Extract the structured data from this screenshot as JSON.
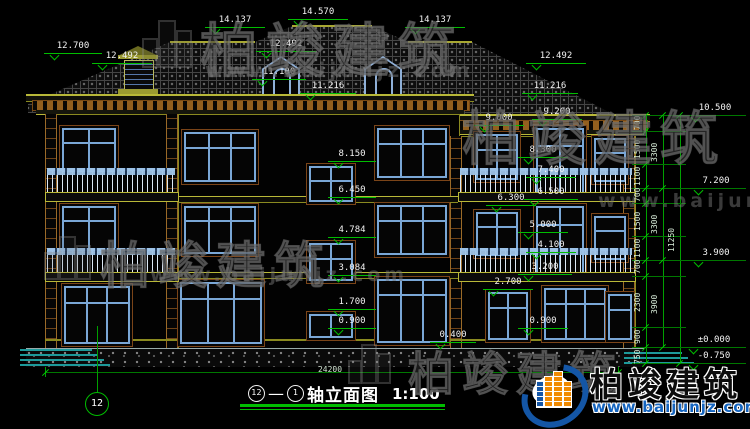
{
  "brand": {
    "name": "柏竣建筑",
    "url": "www.baijunjz.com"
  },
  "title": {
    "axis_from": "12",
    "axis_to": "1",
    "label": "轴立面图",
    "scale": "1:100"
  },
  "axis_bubble": "12",
  "dims": {
    "ground": "24200",
    "overall": "11250",
    "groups": [
      "3300",
      "3300",
      "3900"
    ],
    "segments": [
      "700",
      "1500",
      "1100",
      "700",
      "1500",
      "1100",
      "700",
      "2300",
      "900",
      "750"
    ]
  },
  "levels": [
    "14.137",
    "14.570",
    "14.137",
    "12.700",
    "12.492",
    "12.492",
    "11.100",
    "11.216",
    "12.492",
    "11.216",
    "9.000",
    "9.200",
    "8.300",
    "7.400",
    "6.300",
    "6.500",
    "8.150",
    "6.450",
    "4.784",
    "3.084",
    "1.700",
    "0.900",
    "0.400",
    "5.000",
    "4.100",
    "3.200",
    "2.700",
    "0.900",
    "10.500",
    "7.200",
    "3.900",
    "±0.000",
    "-0.750"
  ],
  "colors": {
    "dimension_green": "#00bd00",
    "window_frame_blue": "#7aa7d6",
    "trim_olive": "#b8b838",
    "cornice_brown": "#935f1e",
    "logo_blue": "#1456a6",
    "logo_orange": "#f18a00"
  }
}
